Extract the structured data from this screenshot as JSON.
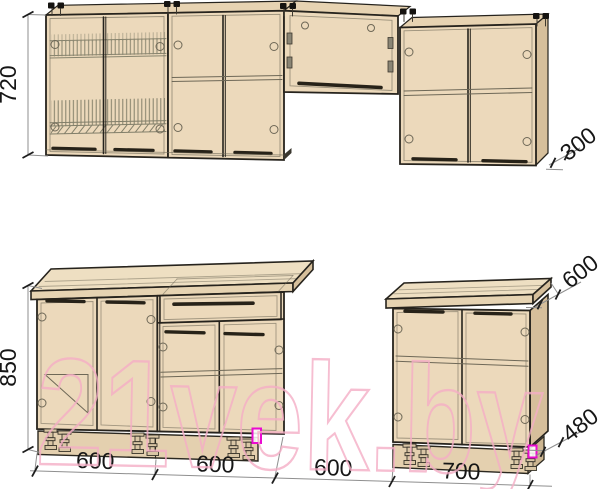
{
  "page": {
    "background": "#ffffff"
  },
  "watermark": {
    "text": "21vek.by",
    "color": "#f5aec6"
  },
  "drawing": {
    "type": "kitchen cabinet set technical drawing",
    "units": "mm",
    "wall_row": {
      "height_label": "720",
      "depth_label": "300"
    },
    "base_row": {
      "height_label": "850",
      "countertop_depth_label": "600",
      "rear_height_label": "480"
    },
    "width_labels": [
      "600",
      "600",
      "600",
      "700"
    ],
    "colors": {
      "cabinet_face": "#ecd9bb",
      "cabinet_top": "#e7d3b2",
      "cabinet_side": "#d6bf9b",
      "countertop": "#eedfc2",
      "plinth": "#e4d0af",
      "outline": "#26231d",
      "dimension_line": "#8f8f8f",
      "dimension_text": "#161616",
      "watermark_pink": "#f5aec6",
      "marker_magenta": "#ea0bd0"
    }
  }
}
